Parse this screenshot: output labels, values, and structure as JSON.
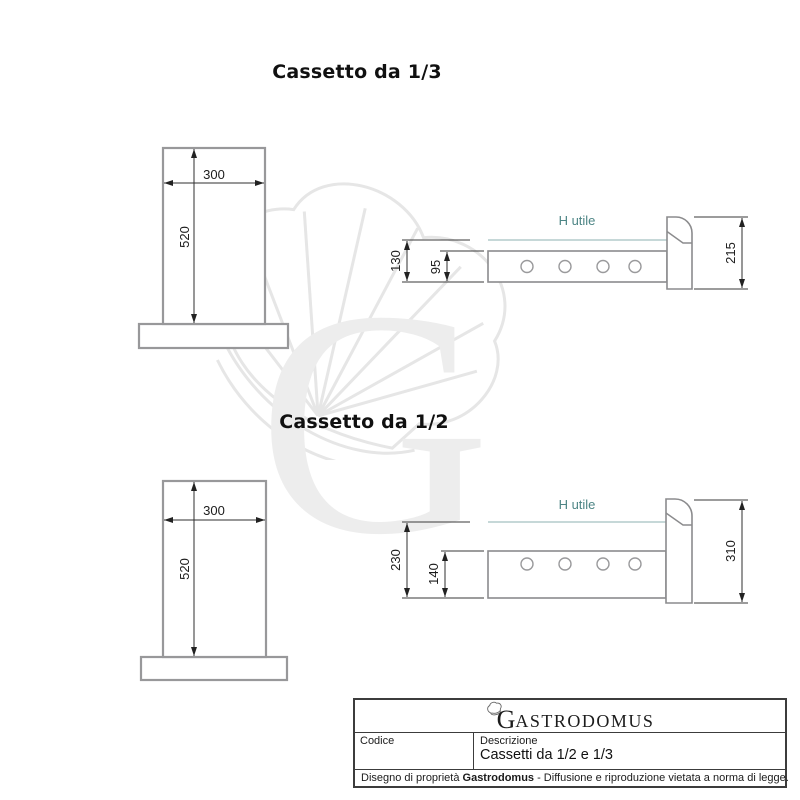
{
  "sections": [
    {
      "title": "Cassetto da 1/3",
      "front_view": {
        "width": "300",
        "height": "520"
      },
      "side_view": {
        "h_utile": "H utile",
        "height_total": "130",
        "height_inner": "95",
        "front_height": "215"
      }
    },
    {
      "title": "Cassetto da 1/2",
      "front_view": {
        "width": "300",
        "height": "520"
      },
      "side_view": {
        "h_utile": "H utile",
        "height_total": "230",
        "height_inner": "140",
        "front_height": "310"
      }
    }
  ],
  "watermark": {
    "letter": "G"
  },
  "title_block": {
    "logo_initial": "G",
    "logo_rest": "ASTRODOMUS",
    "codice_label": "Codice",
    "descrizione_label": "Descrizione",
    "descrizione_value": "Cassetti da 1/2 e 1/3",
    "disclaimer_prefix": "Disegno di proprietà ",
    "disclaimer_brand": "Gastrodomus",
    "disclaimer_suffix": " - Diffusione e riproduzione vietata a norma di legge."
  },
  "colors": {
    "outline_gray": "#98989a",
    "side_outline_gray": "#8b8b8d",
    "dimension_line": "#2f2f2f",
    "h_utile_text": "#4d8585",
    "h_utile_line": "#a4c0c0",
    "watermark_gray": "#ededed",
    "border_dark": "#3c3c3c"
  }
}
